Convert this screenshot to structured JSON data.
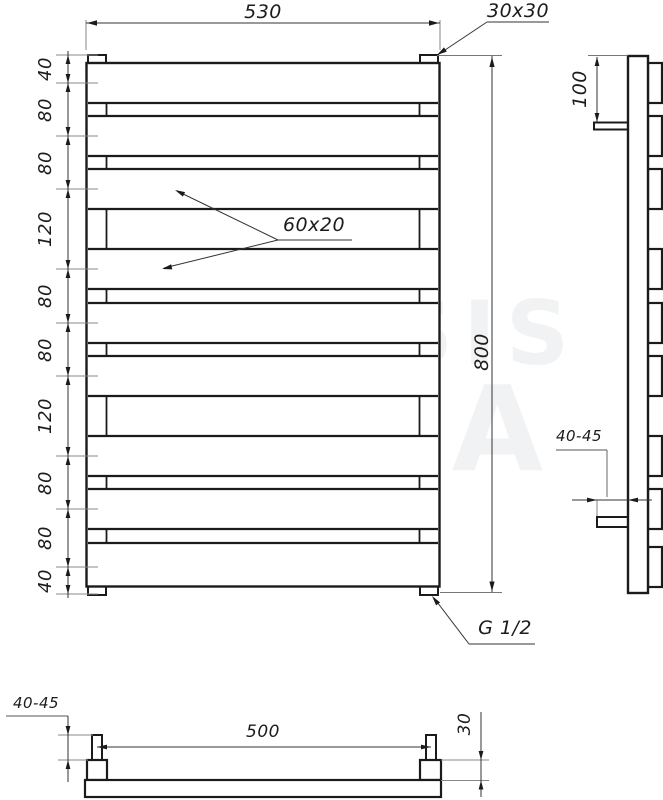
{
  "drawing": {
    "front_view": {
      "width_dim": "530",
      "height_dim": "800",
      "corner_profile_label": "30x30",
      "bar_profile_label": "60x20",
      "connection_label": "G 1/2",
      "left_chain": [
        "40",
        "80",
        "80",
        "120",
        "80",
        "80",
        "120",
        "80",
        "80",
        "40"
      ]
    },
    "side_view": {
      "top_offset_dim": "100",
      "wall_distance_dim": "40-45"
    },
    "bottom_view": {
      "wall_distance_dim": "40-45",
      "mount_spacing_dim": "500",
      "height_dim": "30"
    },
    "watermark": {
      "line1": "GENESIS",
      "line2": "AQUA"
    }
  }
}
